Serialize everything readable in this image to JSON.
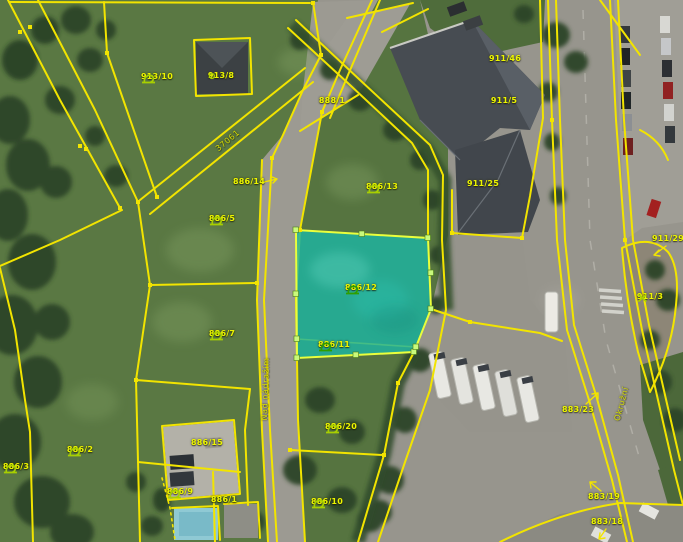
{
  "map": {
    "kind": "cadastral-aerial-view",
    "selected_parcel": "886/12",
    "colors": {
      "parcel_line": "#f2e400",
      "highlight_fill": "#1db5a2",
      "highlight_vertex": "#c9f97c",
      "label_text": "#edf600",
      "grass_icon": "#a8cf00",
      "grass_icon_selected": "#2f9e00"
    },
    "labels": [
      {
        "text": "913/10",
        "x": 157,
        "y": 77,
        "icon": "grass"
      },
      {
        "text": "913/8",
        "x": 221,
        "y": 76,
        "icon": "dot"
      },
      {
        "text": "888/1",
        "x": 332,
        "y": 101
      },
      {
        "text": "886/14",
        "x": 249,
        "y": 182
      },
      {
        "text": "886/13",
        "x": 382,
        "y": 187,
        "icon": "grass"
      },
      {
        "text": "886/5",
        "x": 222,
        "y": 219,
        "icon": "grass"
      },
      {
        "text": "911/25",
        "x": 483,
        "y": 184
      },
      {
        "text": "911/46",
        "x": 505,
        "y": 59
      },
      {
        "text": "911/5",
        "x": 504,
        "y": 101
      },
      {
        "text": "886/12",
        "x": 361,
        "y": 288,
        "icon": "grass",
        "icon_color": "#2f9e00"
      },
      {
        "text": "886/11",
        "x": 334,
        "y": 345,
        "icon": "grass",
        "icon_color": "#2f9e00",
        "icon_pos": "left"
      },
      {
        "text": "886/7",
        "x": 222,
        "y": 334,
        "icon": "grass"
      },
      {
        "text": "886/20",
        "x": 341,
        "y": 427,
        "icon": "grass"
      },
      {
        "text": "886/10",
        "x": 327,
        "y": 502,
        "icon": "grass"
      },
      {
        "text": "886/2",
        "x": 80,
        "y": 450,
        "icon": "grass"
      },
      {
        "text": "886/3",
        "x": 16,
        "y": 467,
        "icon": "grass"
      },
      {
        "text": "886/15",
        "x": 207,
        "y": 443
      },
      {
        "text": "886/9",
        "x": 180,
        "y": 492,
        "icon": "grass"
      },
      {
        "text": "886/1",
        "x": 224,
        "y": 500
      },
      {
        "text": "911/29",
        "x": 668,
        "y": 239
      },
      {
        "text": "911/3",
        "x": 650,
        "y": 297,
        "icon": "cross"
      },
      {
        "text": "883/23",
        "x": 578,
        "y": 410
      },
      {
        "text": "883/19",
        "x": 604,
        "y": 497
      },
      {
        "text": "883/18",
        "x": 607,
        "y": 522
      }
    ],
    "road_labels": [
      {
        "text": "37061",
        "x": 228,
        "y": 141,
        "rot": -40
      },
      {
        "text": "Nad nádražím",
        "x": 266,
        "y": 389,
        "rot": -88
      },
      {
        "text": "Okružní",
        "x": 622,
        "y": 404,
        "rot": -75
      }
    ]
  }
}
